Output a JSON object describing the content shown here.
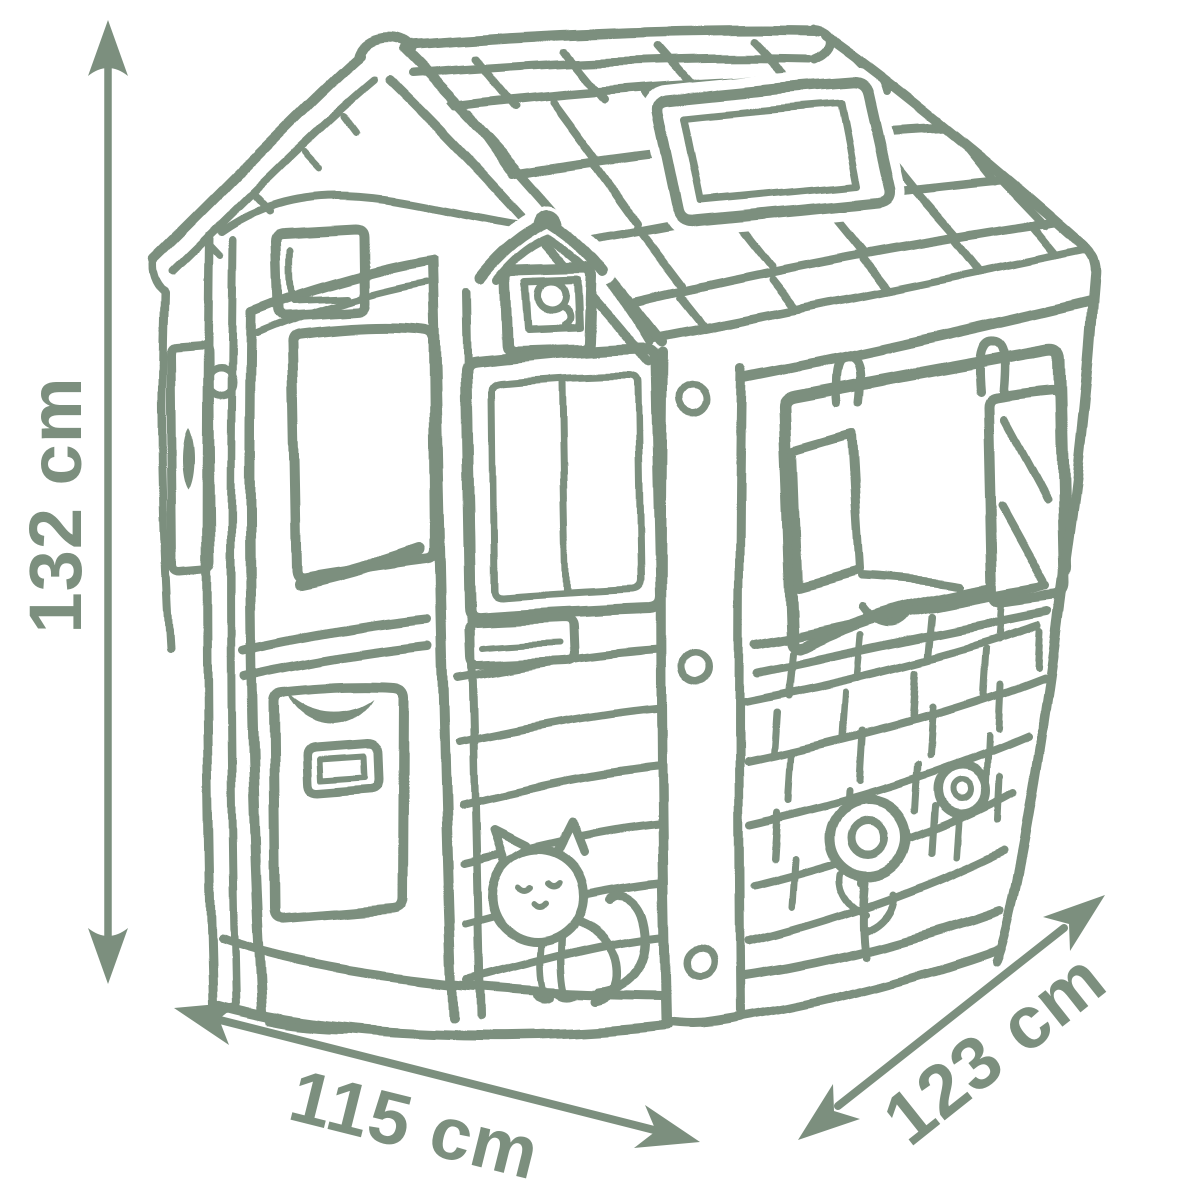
{
  "figure": {
    "subject": "children's playhouse line sketch with dimension arrows"
  },
  "palette": {
    "ink": "#7c8f7e",
    "background": "#ffffff"
  },
  "dimensions": {
    "height": {
      "label": "132 cm"
    },
    "width": {
      "label": "115 cm"
    },
    "depth": {
      "label": "123 cm"
    }
  }
}
